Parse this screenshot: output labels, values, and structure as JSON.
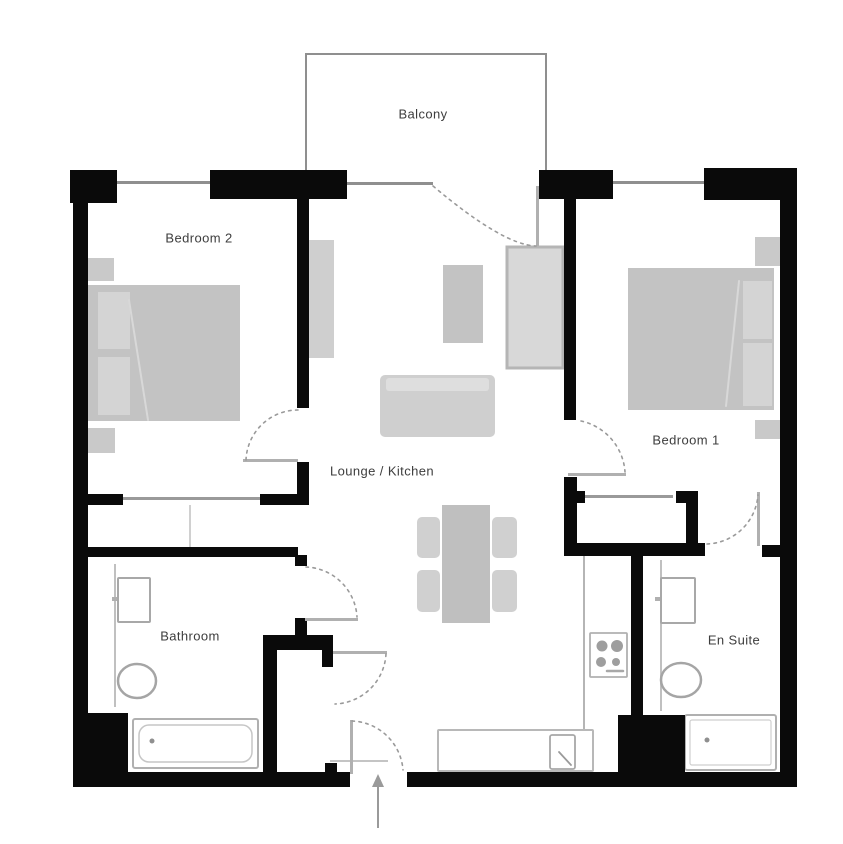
{
  "title": "Apartment floor plan",
  "plan": {
    "canvas": {
      "w": 843,
      "h": 844,
      "bg": "#ffffff"
    },
    "colors": {
      "wall": "#0a0a0a",
      "window_line": "#8f8f8f",
      "arc": "#9a9a9a",
      "leaf": "#b0b0b0",
      "fixture_fill": "#ffffff",
      "label": "#3d3d3d"
    },
    "labels": [
      {
        "id": "balcony",
        "text": "Balcony",
        "x": 423,
        "y": 114
      },
      {
        "id": "bedroom-2",
        "text": "Bedroom 2",
        "x": 199,
        "y": 238
      },
      {
        "id": "bedroom-1",
        "text": "Bedroom 1",
        "x": 686,
        "y": 440
      },
      {
        "id": "lounge-kitchen",
        "text": "Lounge / Kitchen",
        "x": 382,
        "y": 471
      },
      {
        "id": "bathroom",
        "text": "Bathroom",
        "x": 190,
        "y": 636
      },
      {
        "id": "en-suite",
        "text": "En Suite",
        "x": 734,
        "y": 640
      }
    ],
    "walls": [
      {
        "id": "corner-top-left",
        "x": 70,
        "y": 170,
        "w": 47,
        "h": 33
      },
      {
        "id": "top-wall-bedroom2",
        "x": 210,
        "y": 170,
        "w": 137,
        "h": 29
      },
      {
        "id": "top-wall-center",
        "x": 539,
        "y": 170,
        "w": 74,
        "h": 29
      },
      {
        "id": "corner-top-right",
        "x": 704,
        "y": 168,
        "w": 93,
        "h": 32
      },
      {
        "id": "left-wall",
        "x": 73,
        "y": 170,
        "w": 15,
        "h": 617
      },
      {
        "id": "right-wall",
        "x": 780,
        "y": 170,
        "w": 17,
        "h": 617
      },
      {
        "id": "bottom-wall-left",
        "x": 73,
        "y": 772,
        "w": 277,
        "h": 15
      },
      {
        "id": "bottom-wall-right",
        "x": 407,
        "y": 772,
        "w": 390,
        "h": 15
      },
      {
        "id": "entry-jamb",
        "x": 325,
        "y": 763,
        "w": 12,
        "h": 11
      },
      {
        "id": "bathroom-corner-mass",
        "x": 85,
        "y": 713,
        "w": 43,
        "h": 62
      },
      {
        "id": "kitchen-corner-mass",
        "x": 618,
        "y": 715,
        "w": 67,
        "h": 58
      },
      {
        "id": "bedroom2-wall",
        "x": 297,
        "y": 199,
        "w": 12,
        "h": 209
      },
      {
        "id": "bedroom2-door-jamb",
        "x": 297,
        "y": 462,
        "w": 12,
        "h": 43
      },
      {
        "id": "wardrobe-wall-left",
        "x": 87,
        "y": 494,
        "w": 36,
        "h": 11
      },
      {
        "id": "wardrobe-wall-right",
        "x": 260,
        "y": 494,
        "w": 47,
        "h": 11
      },
      {
        "id": "bathroom-top-wall",
        "x": 85,
        "y": 547,
        "w": 213,
        "h": 10
      },
      {
        "id": "bathroom-door-top-jamb",
        "x": 295,
        "y": 555,
        "w": 12,
        "h": 11
      },
      {
        "id": "bathroom-door-bottom-jamb",
        "x": 295,
        "y": 618,
        "w": 12,
        "h": 17
      },
      {
        "id": "vestibule-wall",
        "x": 263,
        "y": 635,
        "w": 70,
        "h": 15
      },
      {
        "id": "vestibule-door-jamb",
        "x": 322,
        "y": 650,
        "w": 11,
        "h": 17
      },
      {
        "id": "bathroom-right-wall",
        "x": 263,
        "y": 650,
        "w": 14,
        "h": 122
      },
      {
        "id": "bedroom1-wall-upper",
        "x": 564,
        "y": 199,
        "w": 12,
        "h": 221
      },
      {
        "id": "bedroom1-wall-lower",
        "x": 564,
        "y": 477,
        "w": 13,
        "h": 78
      },
      {
        "id": "closet-hook-left",
        "x": 574,
        "y": 491,
        "w": 11,
        "h": 12
      },
      {
        "id": "closet-hook-right",
        "x": 676,
        "y": 491,
        "w": 10,
        "h": 12
      },
      {
        "id": "closet-right-wall",
        "x": 686,
        "y": 491,
        "w": 12,
        "h": 64
      },
      {
        "id": "closet-bottom-wall",
        "x": 564,
        "y": 543,
        "w": 141,
        "h": 13
      },
      {
        "id": "ensuite-top-wall-right",
        "x": 762,
        "y": 545,
        "w": 20,
        "h": 12
      },
      {
        "id": "ensuite-left-wall",
        "x": 631,
        "y": 555,
        "w": 12,
        "h": 160
      }
    ],
    "windows": [
      {
        "id": "bedroom2-window",
        "x": 117,
        "y": 181,
        "w": 93,
        "h": 3
      },
      {
        "id": "balcony-window",
        "x": 347,
        "y": 182,
        "w": 86,
        "h": 3
      },
      {
        "id": "bedroom1-window",
        "x": 613,
        "y": 181,
        "w": 91,
        "h": 3
      }
    ],
    "balcony_lines": [
      {
        "id": "balcony-edge-left",
        "x": 305,
        "y": 53,
        "w": 2,
        "h": 119
      },
      {
        "id": "balcony-edge-top",
        "x": 305,
        "y": 53,
        "w": 242,
        "h": 2
      },
      {
        "id": "balcony-edge-right",
        "x": 545,
        "y": 53,
        "w": 2,
        "h": 119
      }
    ],
    "thin_lines": [
      {
        "id": "wardrobe-slider",
        "x": 123,
        "y": 497,
        "w": 137,
        "h": 3,
        "fill": "#9a9a9a"
      },
      {
        "id": "wardrobe-divider",
        "x": 189,
        "y": 505,
        "w": 2,
        "h": 42,
        "fill": "#d0d0d0"
      },
      {
        "id": "closet-slider",
        "x": 585,
        "y": 495,
        "w": 88,
        "h": 3,
        "fill": "#9a9a9a"
      },
      {
        "id": "kitchen-counter-edge",
        "x": 583,
        "y": 553,
        "w": 2,
        "h": 178,
        "fill": "#b5b5b5"
      },
      {
        "id": "bathroom-counter-edge",
        "x": 114,
        "y": 564,
        "w": 2,
        "h": 143,
        "fill": "#c0c0c0"
      },
      {
        "id": "ensuite-counter-edge",
        "x": 660,
        "y": 560,
        "w": 2,
        "h": 151,
        "fill": "#c0c0c0"
      },
      {
        "id": "entry-threshold",
        "x": 330,
        "y": 760,
        "w": 58,
        "h": 2,
        "fill": "#c4c4c4"
      },
      {
        "id": "bathroom-tap",
        "x": 112,
        "y": 597,
        "w": 13,
        "h": 4,
        "fill": "#b0b0b0"
      },
      {
        "id": "ensuite-tap",
        "x": 655,
        "y": 597,
        "w": 13,
        "h": 4,
        "fill": "#b0b0b0"
      }
    ],
    "furniture": [
      {
        "id": "bedroom2-nightstand-top",
        "x": 88,
        "y": 258,
        "w": 26,
        "h": 23,
        "fill": "#c9c9c9"
      },
      {
        "id": "bedroom2-nightstand-bottom",
        "x": 88,
        "y": 428,
        "w": 27,
        "h": 25,
        "fill": "#c9c9c9"
      },
      {
        "id": "bedroom2-bed",
        "x": 88,
        "y": 285,
        "w": 152,
        "h": 136,
        "fill": "#c3c3c3"
      },
      {
        "id": "bedroom2-pillow-1",
        "x": 98,
        "y": 292,
        "w": 32,
        "h": 57,
        "fill": "#d4d4d4"
      },
      {
        "id": "bedroom2-pillow-2",
        "x": 98,
        "y": 357,
        "w": 32,
        "h": 58,
        "fill": "#d4d4d4"
      },
      {
        "id": "bedroom1-nightstand-top",
        "x": 755,
        "y": 237,
        "w": 27,
        "h": 29,
        "fill": "#c9c9c9"
      },
      {
        "id": "bedroom1-nightstand-bottom",
        "x": 755,
        "y": 420,
        "w": 26,
        "h": 19,
        "fill": "#c9c9c9"
      },
      {
        "id": "bedroom1-bed",
        "x": 628,
        "y": 268,
        "w": 146,
        "h": 142,
        "fill": "#c3c3c3"
      },
      {
        "id": "bedroom1-pillow-1",
        "x": 743,
        "y": 281,
        "w": 29,
        "h": 58,
        "fill": "#d4d4d4"
      },
      {
        "id": "bedroom1-pillow-2",
        "x": 743,
        "y": 343,
        "w": 29,
        "h": 63,
        "fill": "#d4d4d4"
      },
      {
        "id": "lounge-unit-left",
        "x": 308,
        "y": 240,
        "w": 26,
        "h": 118,
        "fill": "#cfcfcf"
      },
      {
        "id": "lounge-armchair",
        "x": 443,
        "y": 265,
        "w": 40,
        "h": 78,
        "fill": "#c3c3c3"
      },
      {
        "id": "lounge-unit-right",
        "x": 507,
        "y": 247,
        "w": 56,
        "h": 121,
        "fill": "#d8d8d8",
        "stroke": "#b5b5b5",
        "sw": 3
      },
      {
        "id": "lounge-sofa",
        "x": 380,
        "y": 375,
        "w": 115,
        "h": 62,
        "fill": "#cfcfcf",
        "rx": 5
      },
      {
        "id": "lounge-sofa-back",
        "x": 386,
        "y": 378,
        "w": 103,
        "h": 13,
        "fill": "#dedede",
        "rx": 3
      },
      {
        "id": "dining-table",
        "x": 442,
        "y": 505,
        "w": 48,
        "h": 118,
        "fill": "#bfbfbf"
      },
      {
        "id": "dining-chair-1",
        "x": 417,
        "y": 517,
        "w": 23,
        "h": 41,
        "fill": "#d0d0d0",
        "rx": 5
      },
      {
        "id": "dining-chair-2",
        "x": 492,
        "y": 517,
        "w": 25,
        "h": 41,
        "fill": "#d0d0d0",
        "rx": 5
      },
      {
        "id": "dining-chair-3",
        "x": 417,
        "y": 570,
        "w": 23,
        "h": 42,
        "fill": "#d0d0d0",
        "rx": 5
      },
      {
        "id": "dining-chair-4",
        "x": 492,
        "y": 570,
        "w": 25,
        "h": 42,
        "fill": "#d0d0d0",
        "rx": 5
      }
    ],
    "fixtures": [
      {
        "id": "bathroom-sink",
        "x": 118,
        "y": 578,
        "w": 32,
        "h": 44,
        "stroke": "#a8a8a8",
        "sw": 2,
        "rx": 1
      },
      {
        "id": "bathtub",
        "x": 133,
        "y": 719,
        "w": 125,
        "h": 49,
        "stroke": "#b0b0b0",
        "sw": 2,
        "rx": 2
      },
      {
        "id": "bathtub-inner",
        "x": 139,
        "y": 725,
        "w": 113,
        "h": 37,
        "stroke": "#c6c6c6",
        "sw": 1.5,
        "rx": 10
      },
      {
        "id": "ensuite-sink",
        "x": 661,
        "y": 578,
        "w": 34,
        "h": 45,
        "stroke": "#a8a8a8",
        "sw": 2,
        "rx": 1
      },
      {
        "id": "shower-tray",
        "x": 685,
        "y": 715,
        "w": 91,
        "h": 55,
        "stroke": "#b0b0b0",
        "sw": 2,
        "rx": 2
      },
      {
        "id": "shower-tray-inner",
        "x": 690,
        "y": 720,
        "w": 81,
        "h": 45,
        "stroke": "#cfcfcf",
        "sw": 1.2,
        "rx": 2
      },
      {
        "id": "kitchen-counter",
        "x": 438,
        "y": 730,
        "w": 155,
        "h": 41,
        "stroke": "#b8b8b8",
        "sw": 2,
        "rx": 1
      },
      {
        "id": "kitchen-sink",
        "x": 550,
        "y": 735,
        "w": 25,
        "h": 34,
        "stroke": "#a8a8a8",
        "sw": 1.8,
        "rx": 2
      },
      {
        "id": "stove",
        "x": 590,
        "y": 633,
        "w": 37,
        "h": 44,
        "stroke": "#b0b0b0",
        "sw": 1.8,
        "rx": 1
      }
    ],
    "ellipses": [
      {
        "id": "bathroom-toilet",
        "cx": 137,
        "cy": 681,
        "rx": 19,
        "ry": 17,
        "stroke": "#a5a5a5",
        "sw": 2.5
      },
      {
        "id": "ensuite-toilet",
        "cx": 681,
        "cy": 680,
        "rx": 20,
        "ry": 17,
        "stroke": "#a5a5a5",
        "sw": 2.5
      }
    ],
    "dots": [
      {
        "id": "bathtub-drain",
        "cx": 152,
        "cy": 741,
        "r": 2.5,
        "fill": "#8f8f8f"
      },
      {
        "id": "shower-drain",
        "cx": 707,
        "cy": 740,
        "r": 2.5,
        "fill": "#8f8f8f"
      },
      {
        "id": "stove-burner-1",
        "cx": 602,
        "cy": 646,
        "r": 5.5,
        "fill": "#9e9e9e"
      },
      {
        "id": "stove-burner-2",
        "cx": 617,
        "cy": 646,
        "r": 6,
        "fill": "#9e9e9e"
      },
      {
        "id": "stove-burner-3",
        "cx": 601,
        "cy": 662,
        "r": 5,
        "fill": "#9e9e9e"
      },
      {
        "id": "stove-burner-4",
        "cx": 616,
        "cy": 662,
        "r": 4,
        "fill": "#9e9e9e"
      }
    ],
    "lines": [
      {
        "id": "bedroom2-duvet-fold",
        "x1": 129,
        "y1": 300,
        "x2": 148,
        "y2": 420,
        "stroke": "#d8d8d8",
        "sw": 2
      },
      {
        "id": "bedroom1-duvet-fold",
        "x1": 739,
        "y1": 281,
        "x2": 726,
        "y2": 406,
        "stroke": "#d8d8d8",
        "sw": 2
      },
      {
        "id": "kitchen-faucet",
        "x1": 559,
        "y1": 752,
        "x2": 571,
        "y2": 765,
        "stroke": "#9a9a9a",
        "sw": 1.8
      },
      {
        "id": "stove-control",
        "x1": 607,
        "y1": 671,
        "x2": 623,
        "y2": 671,
        "stroke": "#a8a8a8",
        "sw": 2.5
      }
    ],
    "door_leaves": [
      {
        "id": "balcony-door-leaf",
        "x": 536,
        "y": 186,
        "w": 3,
        "h": 60,
        "fill": "#b0b0b0"
      },
      {
        "id": "bedroom2-door-leaf",
        "x": 243,
        "y": 459,
        "w": 55,
        "h": 3,
        "fill": "#b0b0b0"
      },
      {
        "id": "bathroom-door-leaf",
        "x": 305,
        "y": 618,
        "w": 53,
        "h": 3,
        "fill": "#b0b0b0"
      },
      {
        "id": "bedroom1-door-leaf",
        "x": 568,
        "y": 473,
        "w": 58,
        "h": 3,
        "fill": "#b0b0b0"
      },
      {
        "id": "ensuite-door-leaf",
        "x": 757,
        "y": 492,
        "w": 3,
        "h": 54,
        "fill": "#b0b0b0"
      },
      {
        "id": "vestibule-door-leaf",
        "x": 333,
        "y": 651,
        "w": 54,
        "h": 3,
        "fill": "#b0b0b0"
      },
      {
        "id": "entry-door-leaf",
        "x": 350,
        "y": 720,
        "w": 3,
        "h": 54,
        "fill": "#b0b0b0"
      }
    ],
    "door_arcs": [
      {
        "id": "balcony-door-arc",
        "d": "M433,186 Q503,245 536,246"
      },
      {
        "id": "bedroom2-door-arc",
        "d": "M298,410 A52,52 0 0 0 246,460"
      },
      {
        "id": "bathroom-door-arc",
        "d": "M306,567 A53,53 0 0 1 357,617"
      },
      {
        "id": "bedroom1-door-arc",
        "d": "M581,421 A56,56 0 0 1 625,472"
      },
      {
        "id": "ensuite-door-arc",
        "d": "M707,544 A53,53 0 0 0 758,495"
      },
      {
        "id": "vestibule-door-arc",
        "d": "M386,654 A53,53 0 0 1 335,704"
      },
      {
        "id": "entry-door-arc",
        "d": "M352,721 A53,53 0 0 1 403,770"
      }
    ],
    "entry_arrow": {
      "id": "entry-arrow",
      "line": {
        "x1": 378,
        "y1": 828,
        "x2": 378,
        "y2": 786
      },
      "head": "378,774 372,787 384,787",
      "stroke": "#9a9a9a"
    }
  }
}
